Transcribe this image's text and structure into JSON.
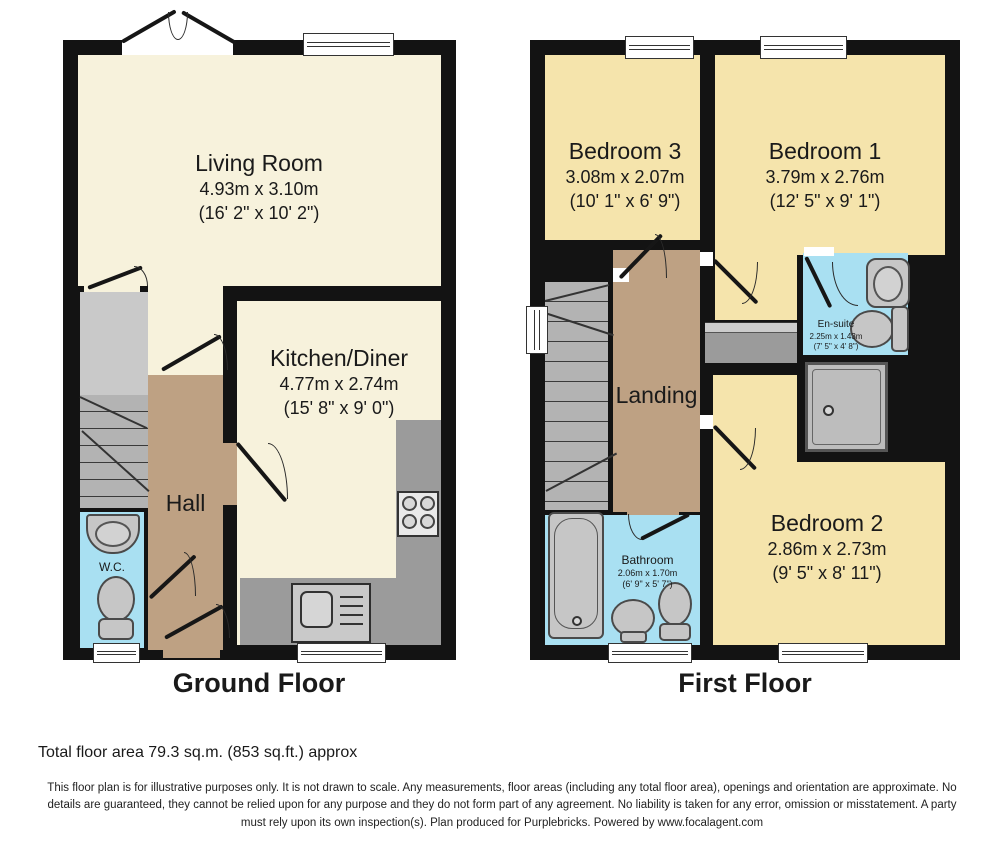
{
  "ground_floor": {
    "title": "Ground Floor",
    "living_room": {
      "name": "Living Room",
      "metric": "4.93m x 3.10m",
      "imperial": "(16' 2\" x 10' 2\")"
    },
    "kitchen_diner": {
      "name": "Kitchen/Diner",
      "metric": "4.77m x 2.74m",
      "imperial": "(15' 8\" x 9' 0\")"
    },
    "hall": {
      "name": "Hall"
    },
    "wc": {
      "name": "W.C."
    }
  },
  "first_floor": {
    "title": "First Floor",
    "bedroom_3": {
      "name": "Bedroom 3",
      "metric": "3.08m x 2.07m",
      "imperial": "(10' 1\" x 6' 9\")"
    },
    "bedroom_1": {
      "name": "Bedroom 1",
      "metric": "3.79m x 2.76m",
      "imperial": "(12' 5\" x 9' 1\")"
    },
    "landing": {
      "name": "Landing"
    },
    "en_suite": {
      "name": "En-suite",
      "metric": "2.25m x 1.43m",
      "imperial": "(7' 5\" x 4' 8\")"
    },
    "bathroom": {
      "name": "Bathroom",
      "metric": "2.06m x 1.70m",
      "imperial": "(6' 9\" x 5' 7\")"
    },
    "bedroom_2": {
      "name": "Bedroom 2",
      "metric": "2.86m x 2.73m",
      "imperial": "(9' 5\" x 8' 11\")"
    }
  },
  "footer": {
    "total_area": "Total floor area 79.3 sq.m. (853 sq.ft.) approx",
    "disclaimer": "This floor plan is for illustrative purposes only. It is not drawn to scale. Any measurements, floor areas (including any total floor area), openings and orientation are approximate. No details are guaranteed, they cannot be relied upon for any purpose and they do not form part of any agreement. No liability is taken for any error, omission or misstatement. A party must rely upon its own inspection(s). Plan produced for Purplebricks. Powered by www.focalagent.com"
  },
  "colors": {
    "wall": "#131313",
    "reception_cream": "#f7f2dc",
    "bedroom_yellow": "#f5e4ac",
    "hall_tan": "#bea183",
    "wet_room_blue": "#a9e0f2",
    "stairs_gray": "#b3b3b3",
    "counter_gray": "#9b9b9b"
  }
}
